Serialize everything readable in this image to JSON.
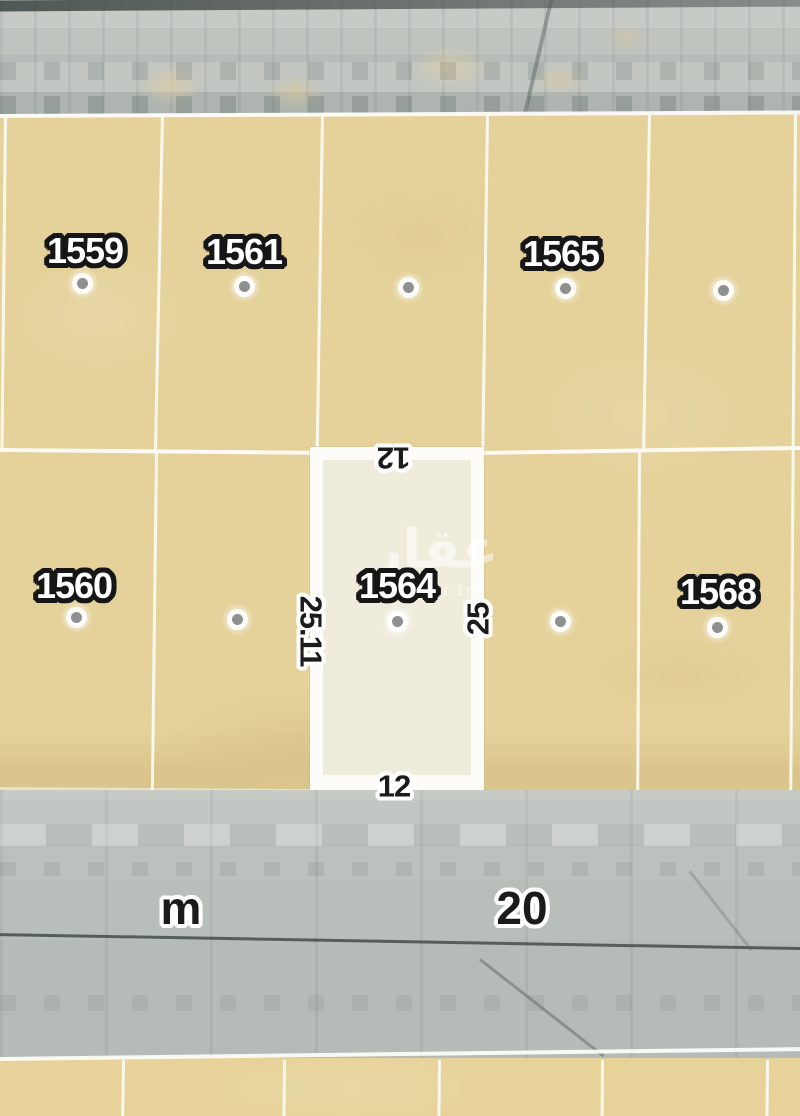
{
  "map_type": "satellite-parcel-map",
  "street": {
    "unit": "m",
    "width": "20"
  },
  "selected_plot": {
    "number": "1564",
    "dim_top": "12",
    "dim_bottom": "12",
    "dim_left": "25.11",
    "dim_right": "25"
  },
  "plots": {
    "top_row_labels": [
      "1559",
      "1561",
      "1565"
    ],
    "middle_row_labels": [
      "1560",
      "1568"
    ],
    "unlabeled_marker_count": 5
  },
  "watermark": {
    "brand": "عقار",
    "site": "sa.aqar.fm"
  },
  "colors": {
    "plot_fill": "#e5d29b",
    "selected_fill": "#f0ecdc",
    "boundary_white": "#fdfcf8",
    "road_gray": "#bcc1bd",
    "marker_dot": "#8e918f",
    "plot_label_text": "#ffffff",
    "plot_label_outline": "#161616",
    "dim_label_text": "#1b1b1b",
    "dim_label_outline": "#ffffff"
  }
}
